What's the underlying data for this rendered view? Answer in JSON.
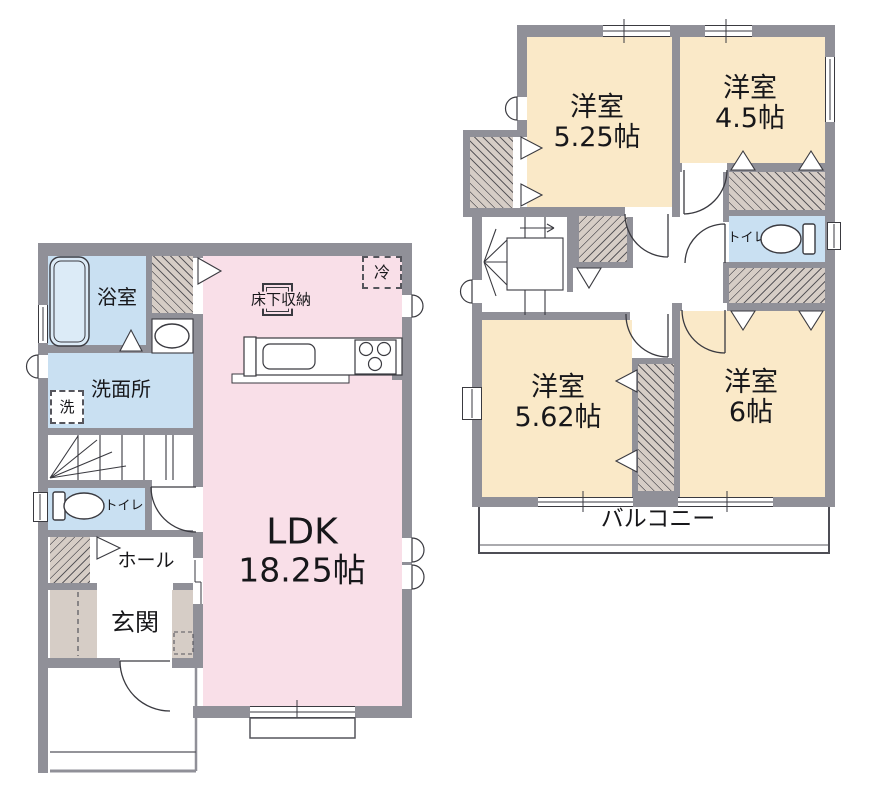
{
  "colors": {
    "wall": "#909098",
    "western_room_fill": "#FAE9C8",
    "ldk_fill": "#F9DFE8",
    "wet_area_fill": "#C9E0F2",
    "closet_fill": "#D6CDC6",
    "line": "#3a3a40"
  },
  "floor1": {
    "bath": "浴室",
    "washroom": "洗面所",
    "laundry": "洗",
    "toilet": "トイレ",
    "hall": "ホール",
    "entrance": "玄関",
    "ldk": "LDK",
    "ldk_size": "18.25帖",
    "underfloor_storage": "床下収納",
    "refrigerator": "冷"
  },
  "floor2": {
    "room1": "洋室",
    "room1_size": "5.25帖",
    "room2": "洋室",
    "room2_size": "4.5帖",
    "toilet": "トイレ",
    "room3": "洋室",
    "room3_size": "5.62帖",
    "room4": "洋室",
    "room4_size": "6帖",
    "balcony": "バルコニー"
  }
}
